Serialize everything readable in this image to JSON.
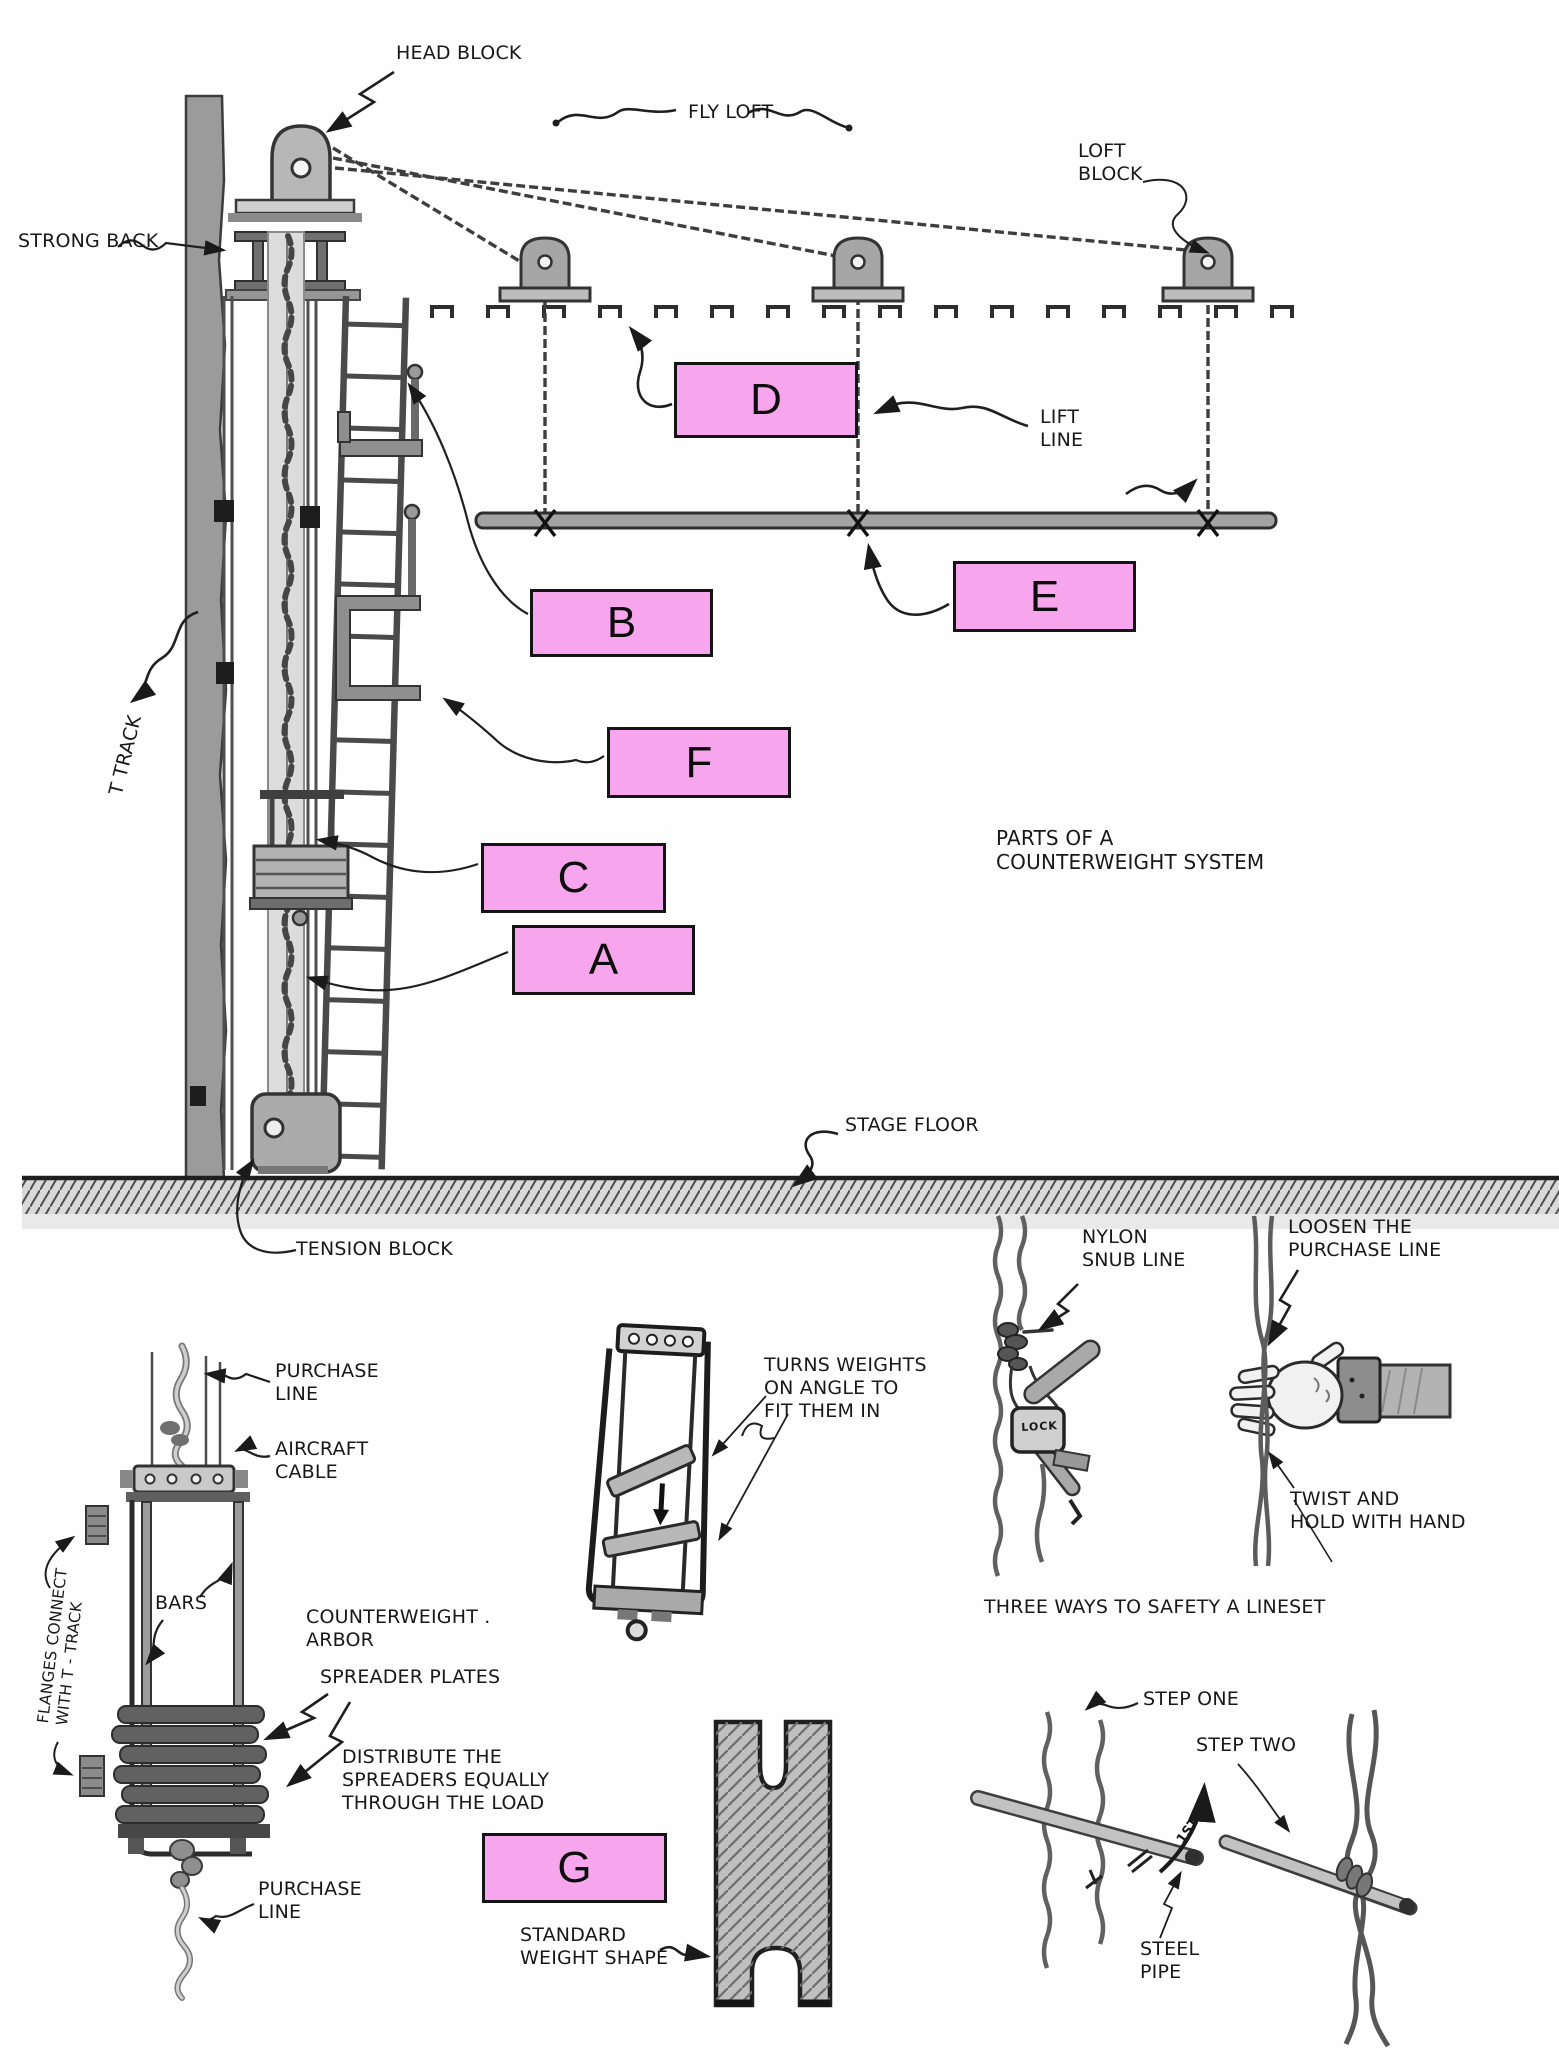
{
  "labels": {
    "head_block": "HEAD BLOCK",
    "fly_loft": "FLY LOFT",
    "loft_block": "LOFT\nBLOCK",
    "strong_back": "STRONG BACK",
    "lift_line": "LIFT\nLINE",
    "t_track": "T TRACK",
    "parts_title": "PARTS OF A\nCOUNTERWEIGHT SYSTEM",
    "stage_floor": "STAGE FLOOR",
    "tension_block": "TENSION BLOCK",
    "purchase_line_top": "PURCHASE\nLINE",
    "aircraft_cable": "AIRCRAFT\nCABLE",
    "bars": "BARS",
    "counterweight_arbor": "COUNTERWEIGHT .\nARBOR",
    "spreader_plates": "SPREADER PLATES",
    "distribute": "DISTRIBUTE THE\nSPREADERS EQUALLY\nTHROUGH THE LOAD",
    "purchase_line_bottom": "PURCHASE\nLINE",
    "flanges": "FLANGES CONNECT\nWITH T - TRACK",
    "turns_weights": "TURNS WEIGHTS\nON ANGLE TO\nFIT THEM IN",
    "nylon_snub": "NYLON\nSNUB LINE",
    "loosen": "LOOSEN THE\nPURCHASE LINE",
    "twist_hold": "TWIST AND\nHOLD WITH HAND",
    "three_ways": "THREE WAYS TO SAFETY A LINESET",
    "step_one": "STEP ONE",
    "step_two": "STEP TWO",
    "steel_pipe": "STEEL\nPIPE",
    "standard_weight": "STANDARD\nWEIGHT SHAPE",
    "lock": "LOCK",
    "first_marker": "1ST"
  },
  "answer_boxes": [
    {
      "letter": "D"
    },
    {
      "letter": "B"
    },
    {
      "letter": "E"
    },
    {
      "letter": "F"
    },
    {
      "letter": "C"
    },
    {
      "letter": "A"
    },
    {
      "letter": "G"
    }
  ],
  "colors": {
    "answer_box_fill": "#f7a6ee",
    "answer_box_border": "#141414",
    "ink": "#181818",
    "pencil_dark": "#3e3e3e",
    "pencil_mid": "#8f8f8f",
    "pencil_light": "#cfcfcf",
    "paper": "#fefefe"
  }
}
